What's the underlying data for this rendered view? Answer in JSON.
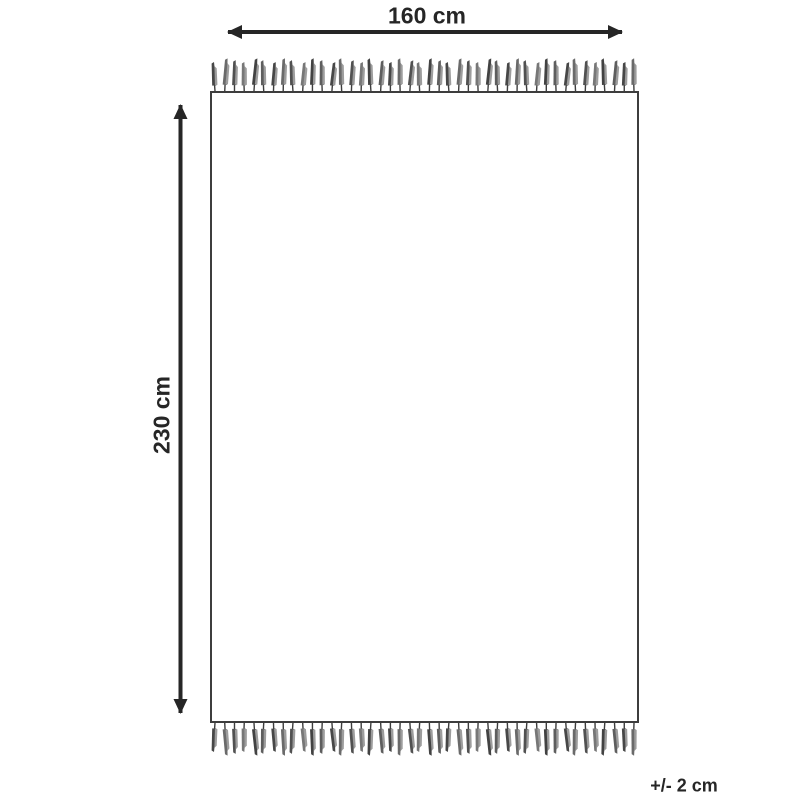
{
  "labels": {
    "width": "160 cm",
    "height": "230 cm",
    "tolerance": "+/- 2 cm"
  },
  "colors": {
    "ink": "#262626",
    "rug_outline": "#3d3d3d",
    "rug_fill": "#ffffff",
    "fringe_stem": "#3d3d3d",
    "fringe_shades": [
      "#474747",
      "#6a6a6a",
      "#515151",
      "#777777",
      "#424242",
      "#5e5e5e"
    ],
    "fringe_highlight": "#9d9d9d"
  },
  "fringe": {
    "tassels_per_edge": 44
  }
}
